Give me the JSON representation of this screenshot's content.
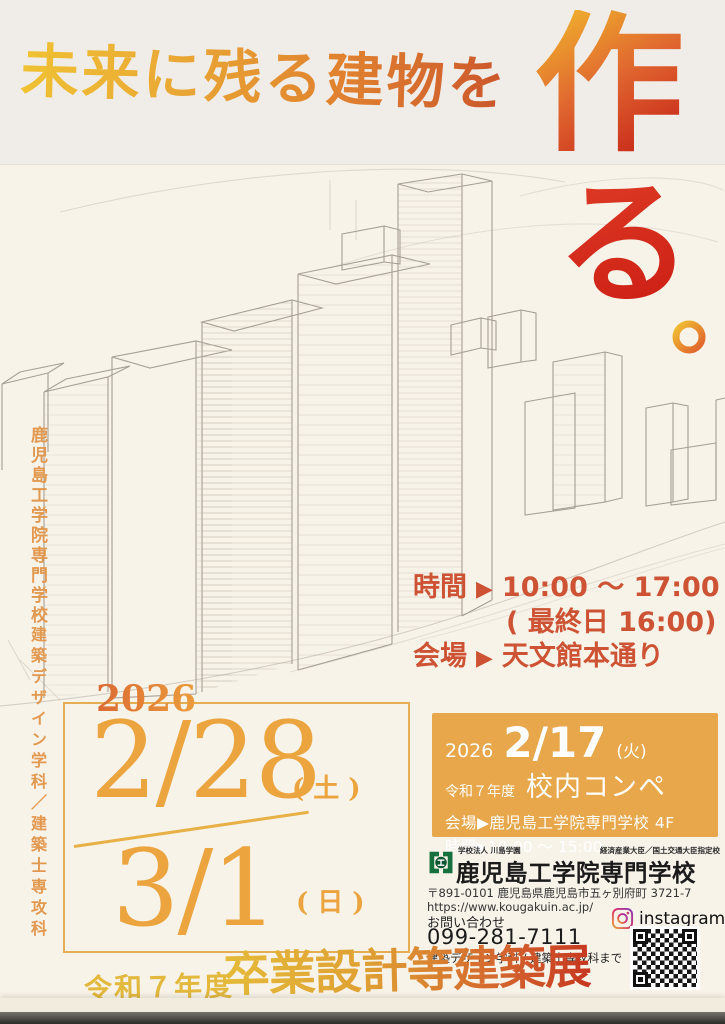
{
  "headline": {
    "text": "未来に残る建物を",
    "big1": "作",
    "big2": "る",
    "period": "。"
  },
  "left_vertical": {
    "school": "鹿児島工学院専門学校",
    "dept": "建築デザイン学科／建築士専攻科"
  },
  "event": {
    "time_label": "時間",
    "arrow": "▶",
    "time_value": "10:00 ～ 17:00",
    "time_note": "( 最終日 16:00)",
    "venue_label": "会場",
    "venue_value": "天文館本通り"
  },
  "dates": {
    "year": "2026",
    "d1": "2/28",
    "d1_dow": "(土)",
    "d2": "3/1",
    "d2_dow": "(日)"
  },
  "compe": {
    "year": "2026",
    "date": "2/17",
    "dow": "(火)",
    "era": "令和７年度",
    "title": "校内コンペ",
    "venue": "会場▶鹿児島工学院専門学校 4F",
    "time": "時間▶10:00 ～ 15:00"
  },
  "school": {
    "corp": "学校法人 川島学園",
    "designation": "経済産業大臣／国土交通大臣指定校",
    "name": "鹿児島工学院専門学校",
    "address": "〒891-0101 鹿児島県鹿児島市五ヶ別府町 3721-7",
    "url": "https://www.kougakuin.ac.jp/"
  },
  "contact": {
    "label": "お問い合わせ",
    "phone": "099-281-7111",
    "note": "建築デザイン学科 / 建築士専攻科まで",
    "instagram": "instagram"
  },
  "footer": {
    "era": "令和７年度",
    "title": "卒業設計等建築展"
  },
  "colors": {
    "headline_yellow": "#f0c233",
    "headline_red": "#c64c2a",
    "big_red": "#cb1d13",
    "date_orange": "#eba43e",
    "vermillion": "#cd5334",
    "compe_box_orange": "#e7a74a",
    "vertical_text_orange": "#e2984f",
    "logo_green": "#17713e",
    "footer_gold": "#e2b83d"
  }
}
